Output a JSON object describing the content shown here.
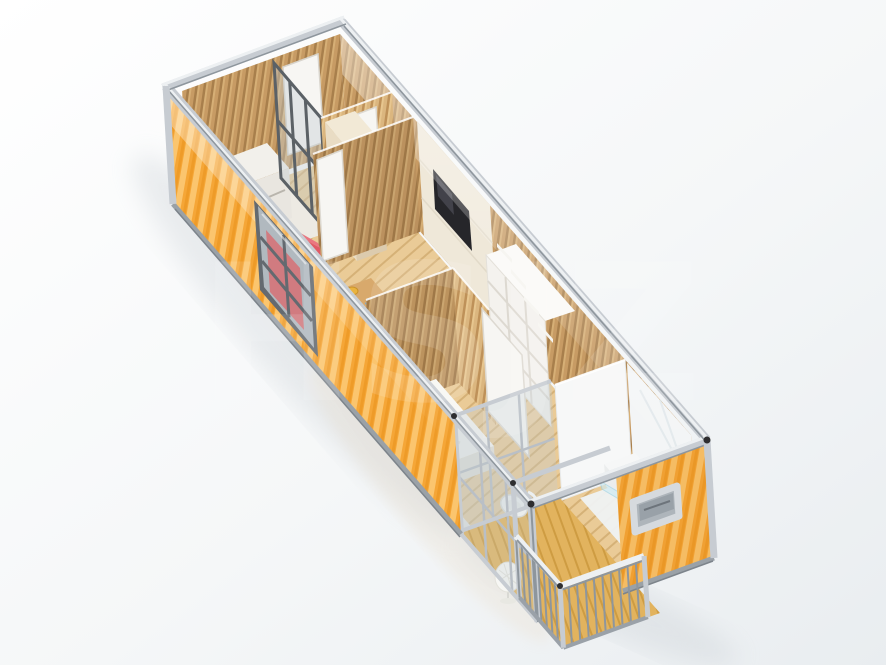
{
  "meta": {
    "title": "Isometric 3D render of a single-unit container house floor plan",
    "canvas": {
      "width": 886,
      "height": 665
    }
  },
  "watermark": {
    "text": "HSJZ",
    "opacity": "0.12"
  },
  "palette": {
    "bg1": "#ffffff",
    "bg2": "#e9edf0",
    "orange": "#F5A637",
    "orangeLight": "#FBC56E",
    "orangeDark": "#EE9B28",
    "steel": "#C7CCD2",
    "steelLight": "#EDF0F2",
    "steelDark": "#8E969D",
    "frameDark": "#5B6166",
    "wood": "#C79B64",
    "woodDark": "#A87F4C",
    "woodLight": "#D6AF76",
    "woodLit": "#DBB67F",
    "woodLitGroove": "#BE9159",
    "floor": "#EACB97",
    "floorLine": "#D5B177",
    "deck": "#E2B35E",
    "deckLine": "#CE9C42",
    "cream": "#EFE8D9",
    "white": "#F7F6F3",
    "marble": "#F3F5F6",
    "red": "#E05A65",
    "redDark": "#D54F5A",
    "redLight": "#EA7680",
    "tv": "#26262A",
    "glass": "#C2CCD2",
    "shadow": "#C9CFD4"
  }
}
